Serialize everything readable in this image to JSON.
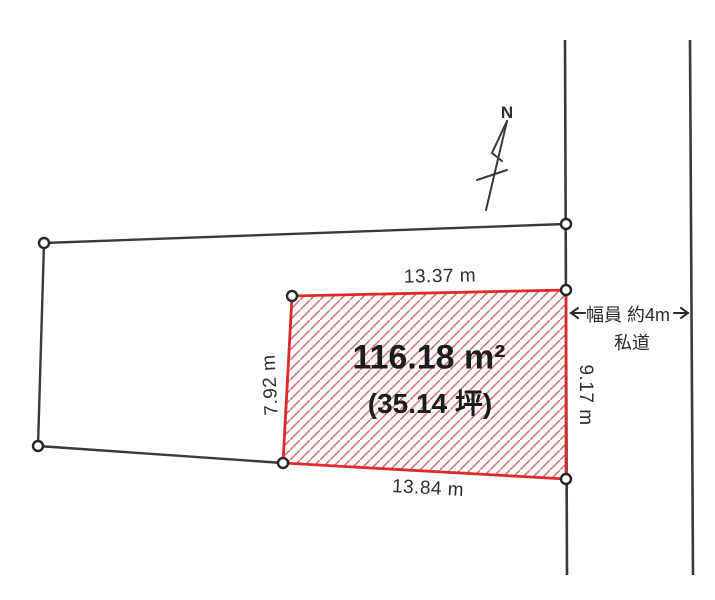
{
  "drawing": {
    "compass": {
      "north_label": "N"
    },
    "parcel": {
      "area_label": "116.18 m²",
      "area_tsubo_label": "(35.14 坪)",
      "dimensions": {
        "top": "13.37 m",
        "bottom": "13.84 m",
        "left": "7.92 m",
        "right": "9.17 m"
      }
    },
    "road": {
      "width_label": "幅員 約4m",
      "type_label": "私道"
    },
    "colors": {
      "outline_black": "#3a3a3a",
      "parcel_red": "#dd2a2a",
      "hatch_red": "#d4737a"
    }
  }
}
